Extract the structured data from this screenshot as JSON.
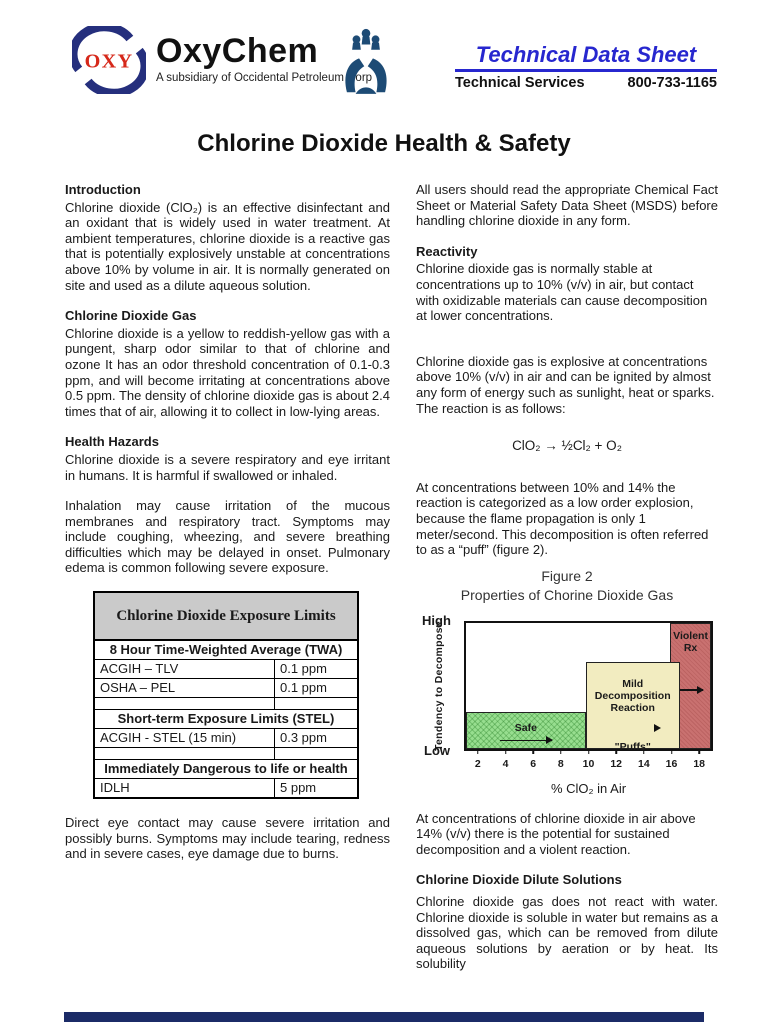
{
  "header": {
    "oxy_mark_text": "OXY",
    "brand": "OxyChem",
    "brand_subtitle": "A subsidiary of Occidental Petroleum Corp",
    "tds_title": "Technical Data Sheet",
    "services_label": "Technical Services",
    "phone": "800-733-1165",
    "colors": {
      "tds_blue": "#2727cf",
      "oxy_red": "#d6281a",
      "logo_navy": "#252f7d",
      "hands_navy": "#1d4b75"
    }
  },
  "page_title": "Chlorine Dioxide Health & Safety",
  "left": {
    "intro_heading": "Introduction",
    "intro_p": "Chlorine dioxide (ClO₂) is an effective disinfectant and an oxidant that is widely used in water treatment.  At ambient temperatures, chlorine dioxide is a reactive gas that is potentially explosively unstable at concentrations above 10% by volume in air.  It is normally generated on site and used as a dilute aqueous solution.",
    "gas_heading": "Chlorine Dioxide Gas",
    "gas_p": "Chlorine dioxide is a yellow to reddish-yellow gas with a pungent, sharp odor similar to that of chlorine and ozone It has an odor threshold concentration of 0.1-0.3 ppm, and will become irritating at concentrations above 0.5 ppm. The density of chlorine dioxide gas is about 2.4 times that of air, allowing it to collect in low-lying areas.",
    "hazards_heading": "Health Hazards",
    "hazards_p1": "Chlorine dioxide is a severe respiratory and eye irritant in humans. It is harmful if swallowed or inhaled.",
    "hazards_p2": "Inhalation may cause irritation of the mucous membranes and respiratory tract.  Symptoms may include coughing, wheezing, and severe breathing difficulties which may be delayed in onset.  Pulmonary edema is common following severe exposure.",
    "eye_p": "Direct eye contact may cause severe irritation and possibly burns.  Symptoms may include tearing, redness and in severe cases, eye damage due to burns."
  },
  "exposure_table": {
    "title": "Chlorine Dioxide Exposure Limits",
    "groups": [
      {
        "header": "8 Hour Time-Weighted Average (TWA)",
        "rows": [
          {
            "label": "ACGIH – TLV",
            "value": "0.1 ppm"
          },
          {
            "label": "OSHA – PEL",
            "value": "0.1 ppm"
          }
        ]
      },
      {
        "header": "Short-term Exposure Limits (STEL)",
        "rows": [
          {
            "label": "ACGIH - STEL (15 min)",
            "value": "0.3 ppm"
          }
        ]
      },
      {
        "header": "Immediately Dangerous to life or health",
        "rows": [
          {
            "label": "IDLH",
            "value": "5 ppm"
          }
        ]
      }
    ]
  },
  "right": {
    "users_p": "All users should read the appropriate Chemical Fact Sheet or Material Safety Data Sheet (MSDS) before handling chlorine dioxide in any form.",
    "reactivity_heading": "Reactivity",
    "reactivity_p": "Chlorine dioxide gas is normally stable at concentrations up to 10% (v/v) in air, but contact with oxidizable materials can cause decomposition at lower concentrations.",
    "explosive_p": "Chlorine dioxide gas is explosive at concentrations above 10% (v/v) in air and can be ignited by almost any form of energy such as sunlight, heat or sparks. The reaction is as follows:",
    "equation": "ClO₂ → ½Cl₂ + O₂",
    "puff_p": "At concentrations between 10% and 14% the reaction is categorized as a low order explosion, because the flame propagation is only 1 meter/second.  This decomposition is often referred to as a “puff” (figure 2).",
    "above14_p": "At concentrations of chlorine dioxide in air above 14% (v/v) there is the potential for sustained decomposition and a violent reaction.",
    "dilute_heading": "Chlorine Dioxide Dilute Solutions",
    "dilute_p": "Chlorine dioxide gas does not react with water. Chlorine dioxide is soluble in water but remains as a dissolved gas, which can be removed from dilute aqueous solutions by aeration or by heat. Its solubility"
  },
  "chart_data": {
    "type": "area",
    "title": "Figure 2",
    "subtitle": "Properties of Chorine Dioxide Gas",
    "xlabel": "% ClO₂ in Air",
    "ylabel": "Tendency to Decompose",
    "y_end_labels": {
      "top": "High",
      "bottom": "Low"
    },
    "x_ticks": [
      2,
      4,
      6,
      8,
      10,
      12,
      14,
      16,
      18
    ],
    "x_range": [
      1,
      19
    ],
    "grid": false,
    "legend": "none",
    "regions": [
      {
        "id": "safe",
        "label": "Safe",
        "x_start": 1,
        "x_end": 9.8,
        "height_frac": 0.29,
        "color": "#97de8f"
      },
      {
        "id": "mild",
        "label_lines": [
          "Mild",
          "Decomposition",
          "Reaction"
        ],
        "sublabel": "\"Puffs\"",
        "x_start": 9.8,
        "x_end": 16.7,
        "height_frac": 0.69,
        "color": "#f2ecc0"
      },
      {
        "id": "violent",
        "label_lines": [
          "Violent",
          "Rx"
        ],
        "x_start": 16,
        "x_end": 19,
        "height_frac": 1.0,
        "color": "#c97170"
      }
    ]
  }
}
